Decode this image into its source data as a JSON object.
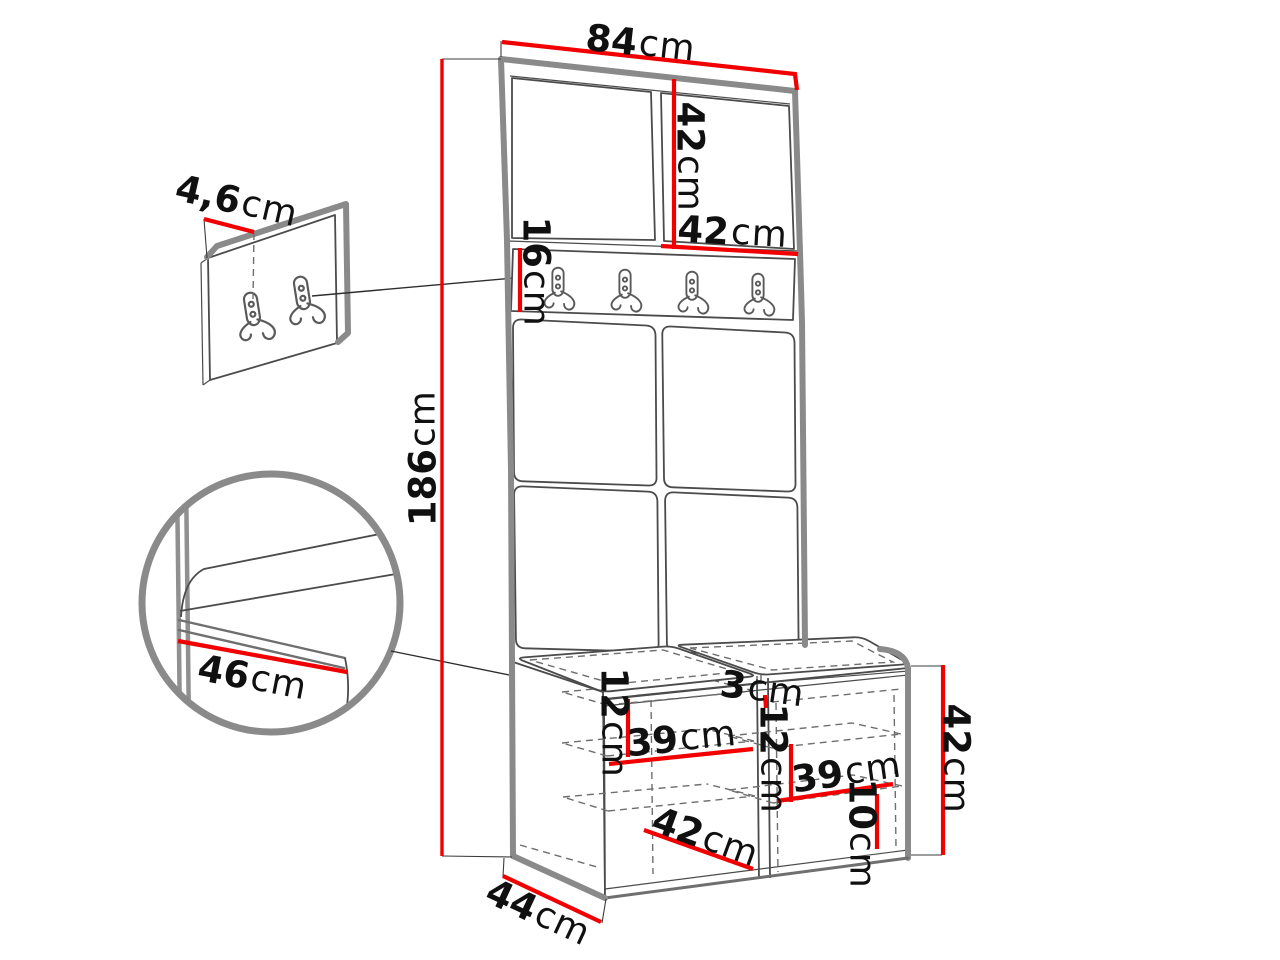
{
  "colors": {
    "dimension_red": "#f20000",
    "outline_gray": "#8a8a8a",
    "line_dark": "#4b4b4b",
    "text": "#101010",
    "background": "#ffffff"
  },
  "icons": {
    "coat_hook": "double-coat-hook-icon",
    "detail_circle": "zoom-detail-circle"
  },
  "dims": {
    "overall_width": {
      "value": "84",
      "unit": "cm"
    },
    "cabinet_door_height": {
      "value": "42",
      "unit": "cm"
    },
    "cabinet_door_width": {
      "value": "42",
      "unit": "cm"
    },
    "hook_panel_height": {
      "value": "16",
      "unit": "cm"
    },
    "overall_height": {
      "value": "186",
      "unit": "cm"
    },
    "wall_panel_depth": {
      "value": "4,6",
      "unit": "cm"
    },
    "detail_seat_depth": {
      "value": "46",
      "unit": "cm"
    },
    "bench_left_shelf_gap": {
      "value": "12",
      "unit": "cm"
    },
    "bench_left_shelf_width": {
      "value": "39",
      "unit": "cm"
    },
    "bench_compartment_width": {
      "value": "42",
      "unit": "cm"
    },
    "bench_divider_thickness": {
      "value": "3",
      "unit": "cm"
    },
    "bench_right_shelf_gap": {
      "value": "12",
      "unit": "cm"
    },
    "bench_right_shelf_width": {
      "value": "39",
      "unit": "cm"
    },
    "bench_bottom_gap": {
      "value": "10",
      "unit": "cm"
    },
    "bench_height": {
      "value": "42",
      "unit": "cm"
    },
    "bench_depth": {
      "value": "44",
      "unit": "cm"
    }
  }
}
